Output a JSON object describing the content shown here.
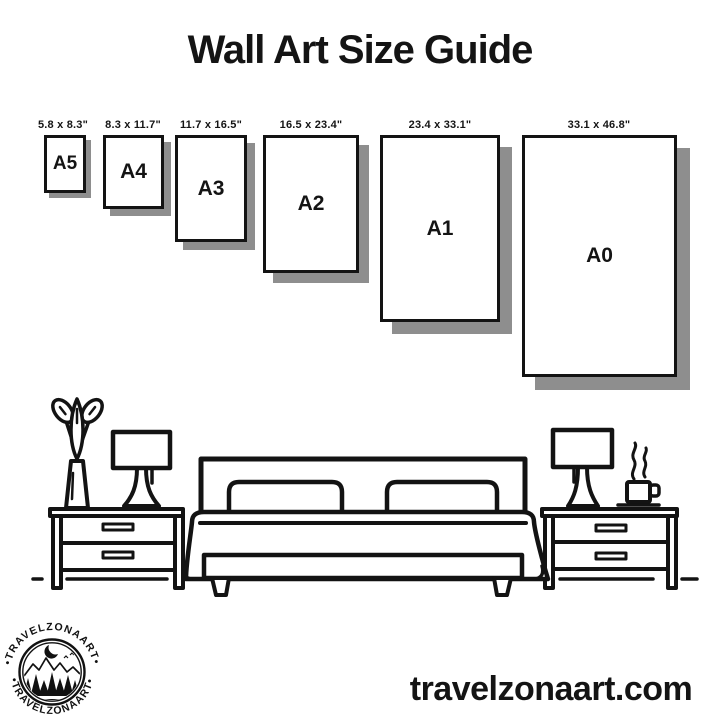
{
  "header": {
    "title": "Wall Art Size Guide"
  },
  "sizes": [
    {
      "label": "A5",
      "dimensions": "5.8 x 8.3\""
    },
    {
      "label": "A4",
      "dimensions": "8.3 x 11.7\""
    },
    {
      "label": "A3",
      "dimensions": "11.7 x 16.5\""
    },
    {
      "label": "A2",
      "dimensions": "16.5 x 23.4\""
    },
    {
      "label": "A1",
      "dimensions": "23.4 x 33.1\""
    },
    {
      "label": "A0",
      "dimensions": "33.1 x 46.8\""
    }
  ],
  "logo": {
    "arc_text": "•TRAVELZONAART•",
    "brand": "TRAVELZONAART"
  },
  "footer": {
    "website": "travelzonaart.com"
  },
  "colors": {
    "ink": "#111111",
    "shadow": "#8e8e8e",
    "background": "#ffffff"
  },
  "scene": {
    "furniture": [
      "potted-plant",
      "table-lamp",
      "nightstand",
      "bed",
      "pillow",
      "pillow",
      "nightstand",
      "table-lamp",
      "coffee-cup"
    ]
  }
}
